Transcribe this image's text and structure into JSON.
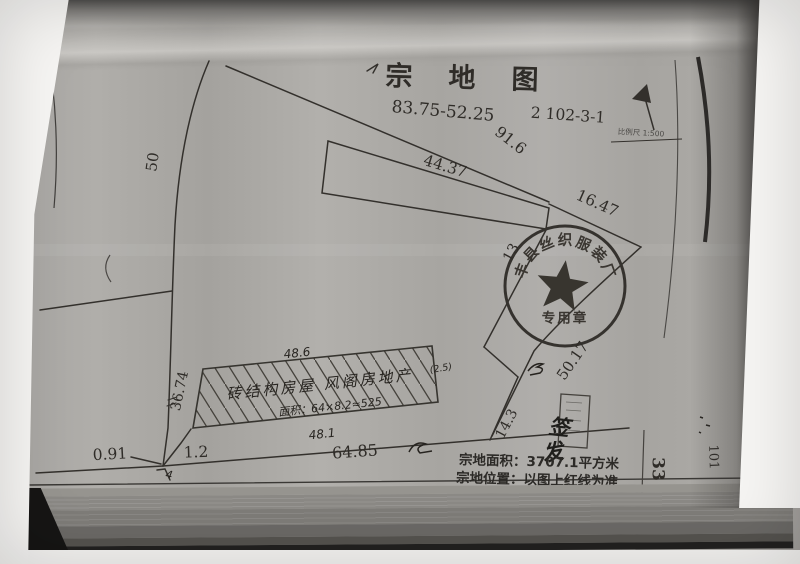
{
  "sheet": {
    "title": "宗地图",
    "plot_code": "83.75-52.25",
    "parcel_number": "2 102-3-1",
    "scale_label": "比例尺 1:500",
    "area_label": "宗地面积：3707.1平方米",
    "location_label": "宗地位置：以图上红线为准",
    "page_number": "33",
    "margin_number": "101"
  },
  "dimensions": {
    "north_boundary": "91.6",
    "strip_length": "44.37",
    "northeast_segment": "16.47",
    "west_boundary": "50",
    "east_segment_upper": "13",
    "east_boundary": "50.17",
    "east_segment_lower": "14.3",
    "south_boundary": "64.85",
    "south_offset_small": "0.91",
    "south_cap": "1.2",
    "corner_note": "4"
  },
  "building": {
    "top_dim": "48.6",
    "bottom_dim": "48.1",
    "left_dim": "36.74",
    "right_note": "(2.5)",
    "note_line1": "砖结构房屋 风阁房地产",
    "note_line2": "面积：64×8.2≈525"
  },
  "stamp": {
    "arc_chars": [
      "丰",
      "县",
      "丝",
      "织",
      "服",
      "装",
      "厂"
    ],
    "bottom_text": "专用章"
  },
  "annotations": {
    "scribble_char_1": "签",
    "scribble_char_2": "发"
  }
}
